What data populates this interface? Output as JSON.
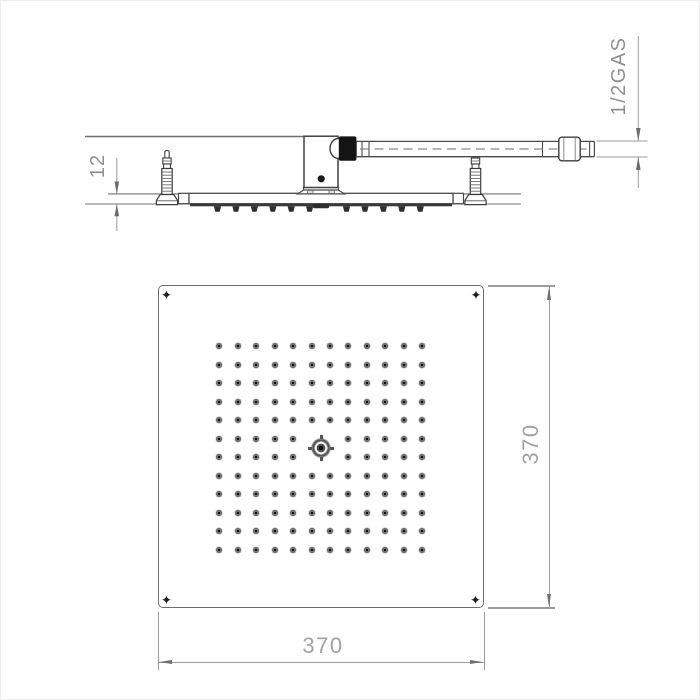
{
  "drawing": {
    "kind": "technical dimension drawing",
    "subject": "square ceiling-mounted rain shower head",
    "views": [
      "side section view",
      "face (spray plate) view"
    ]
  },
  "dimensions": {
    "plate_thickness": {
      "value": "12"
    },
    "connection_thread": {
      "value": "1/2GAS"
    },
    "plate_width": {
      "value": "370"
    },
    "plate_height": {
      "value": "370"
    }
  },
  "side_view": {
    "spray_bumps": {
      "count": 12,
      "skip_index": 6,
      "start_x": 216.5,
      "spacing": 18.43,
      "top": 205.3,
      "height": 5.4,
      "half_top": 3.6,
      "half_bottom": 2.2,
      "color": "#2e2e2e"
    },
    "anchor_count": 2
  },
  "face_view": {
    "corner_screw_glyph": "✦",
    "corner_screw_count": 4,
    "nozzle_grid": {
      "rows": 12,
      "cols": 12,
      "start_x": 218.4,
      "start_y": 345,
      "spacing_x": 18.42,
      "spacing_y": 18.5,
      "center_skip_cols": [
        5,
        6
      ],
      "center_skip_rows": [
        5,
        6
      ],
      "regular_nozzle_count": 140,
      "central_nozzle_count": 1
    }
  },
  "colors": {
    "part_line": "#4a4a4a",
    "dim_line": "#9b9b9b",
    "dim_text": "#a2a2a2",
    "svg_text": "#8f8f8f",
    "black_fitting": "#141414",
    "background": "#ffffff"
  }
}
